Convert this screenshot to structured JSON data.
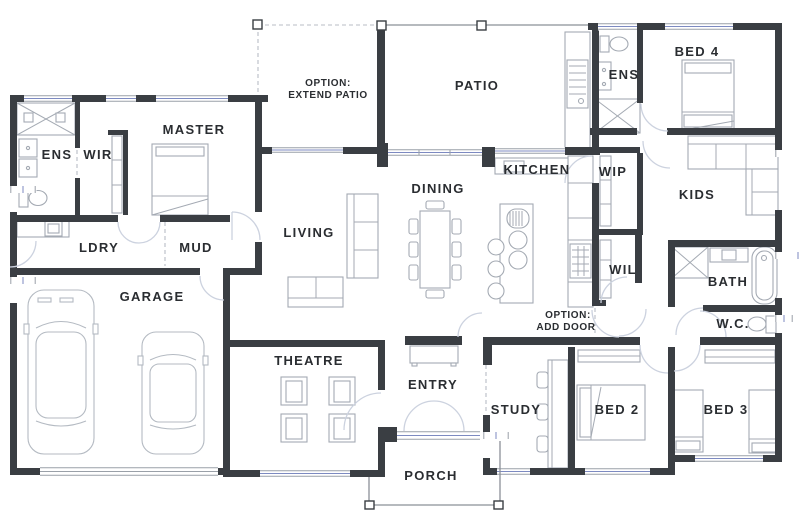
{
  "plan": {
    "type": "residential-floor-plan",
    "colors": {
      "wall": "#3a3e43",
      "label": "#2a2d31",
      "furniture": "#a4aab3",
      "carline": "#b4bac2",
      "door": "#ccd2df",
      "glazing": "#7d8ac1",
      "winline": "#9aa0a8",
      "dashline": "#b9bdc5",
      "porchline": "#8b9098",
      "background": "#ffffff"
    },
    "rooms": {
      "ens_master": {
        "label": "ENS"
      },
      "wir": {
        "label": "WIR"
      },
      "master": {
        "label": "MASTER"
      },
      "ldry": {
        "label": "LDRY"
      },
      "mud": {
        "label": "MUD"
      },
      "garage": {
        "label": "GARAGE"
      },
      "living": {
        "label": "LIVING"
      },
      "dining": {
        "label": "DINING"
      },
      "kitchen": {
        "label": "KITCHEN"
      },
      "patio": {
        "label": "PATIO"
      },
      "theatre": {
        "label": "THEATRE"
      },
      "entry": {
        "label": "ENTRY"
      },
      "porch": {
        "label": "PORCH"
      },
      "study": {
        "label": "STUDY"
      },
      "bed2": {
        "label": "BED 2"
      },
      "bed3": {
        "label": "BED 3"
      },
      "bed4": {
        "label": "BED 4"
      },
      "kids": {
        "label": "KIDS"
      },
      "ens2": {
        "label": "ENS"
      },
      "wip": {
        "label": "WIP"
      },
      "wil": {
        "label": "WIL"
      },
      "bath": {
        "label": "BATH"
      },
      "wc": {
        "label": "W.C."
      }
    },
    "options": {
      "extend_patio": {
        "line1": "OPTION:",
        "line2": "EXTEND PATIO"
      },
      "add_door": {
        "line1": "OPTION:",
        "line2": "ADD DOOR"
      }
    }
  }
}
